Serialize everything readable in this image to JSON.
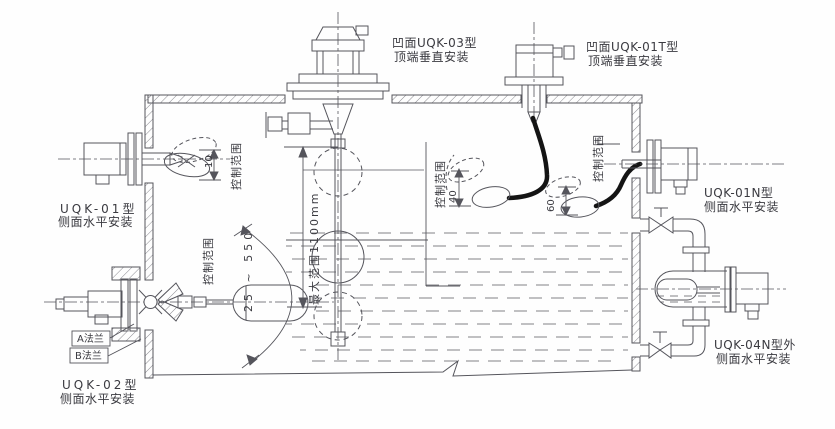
{
  "diagram": {
    "background": "#fefefe",
    "colors": {
      "line": "#55555c",
      "text": "#3a3a40",
      "cable": "#141414",
      "hatch": "#8a8a90"
    },
    "devices": [
      {
        "id": "uqk-03",
        "model": "凹面UQK-03型",
        "mount": "顶端垂直安装"
      },
      {
        "id": "uqk-01t",
        "model": "凹面UQK-01T型",
        "mount": "顶端垂直安装"
      },
      {
        "id": "uqk-01",
        "model": "UQK-01型",
        "mount": "侧面水平安装"
      },
      {
        "id": "uqk-01n",
        "model": "UQK-01N型",
        "mount": "侧面水平安装"
      },
      {
        "id": "uqk-02",
        "model": "UQK-02型",
        "mount": "侧面水平安装"
      },
      {
        "id": "uqk-04n",
        "model": "UQK-04N型外",
        "mount": "侧面水平安装"
      }
    ],
    "annotations": {
      "control_range": "控制范围",
      "max_range": "最大范围1100mm",
      "uqk01_range_mm": "10",
      "uqk01t_range_mm": "40",
      "uqk01n_range_mm": "60",
      "uqk02_range_mm": "25 ~ 550",
      "flange_a": "A法兰",
      "flange_b": "B法兰"
    }
  }
}
